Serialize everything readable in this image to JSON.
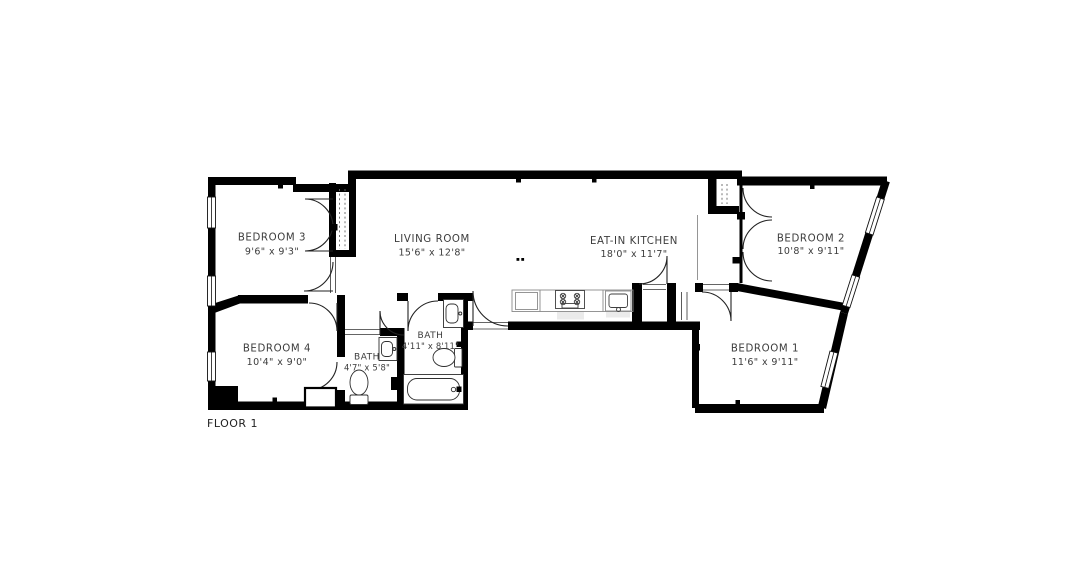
{
  "floor_plan": {
    "floor_label": "FLOOR 1",
    "background_color": "#ffffff",
    "wall_color": "#000000",
    "text_color": "#3c3c3c",
    "rooms": [
      {
        "id": "bedroom-3",
        "name": "BEDROOM 3",
        "dims": "9'6\" x 9'3\""
      },
      {
        "id": "living-room",
        "name": "LIVING ROOM",
        "dims": "15'6\" x 12'8\""
      },
      {
        "id": "eat-in-kitchen",
        "name": "EAT-IN KITCHEN",
        "dims": "18'0\" x 11'7\""
      },
      {
        "id": "bedroom-2",
        "name": "BEDROOM 2",
        "dims": "10'8\" x 9'11\""
      },
      {
        "id": "bedroom-4",
        "name": "BEDROOM 4",
        "dims": "10'4\" x 9'0\""
      },
      {
        "id": "bath-1",
        "name": "BATH",
        "dims": "4'7\" x 5'8\""
      },
      {
        "id": "bath-2",
        "name": "BATH",
        "dims": "4'11\" x 8'11\""
      },
      {
        "id": "bedroom-1",
        "name": "BEDROOM 1",
        "dims": "11'6\" x 9'11\""
      }
    ],
    "fixture_icons": [
      "stove-icon",
      "kitchen-sink-icon",
      "toilet-icon",
      "bathtub-icon",
      "vanity-sink-icon",
      "closet-icon",
      "door-swing-icon",
      "window-icon"
    ]
  }
}
